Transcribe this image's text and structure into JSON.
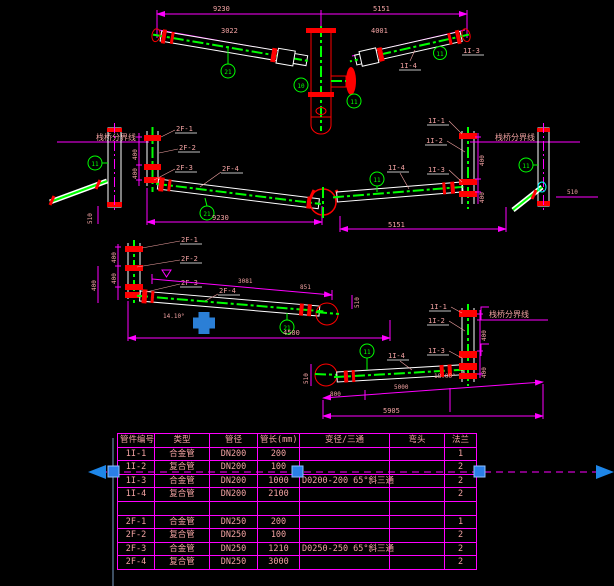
{
  "drawing": {
    "background": "#000000",
    "colors": {
      "dimension_line": "#ff00ff",
      "pipe_outline": "#ffffff",
      "pipe_centerline": "#00ff00",
      "fitting_red": "#ff0000",
      "label_text": "#f2a2a2",
      "grip_blue": "#2a7fe8"
    },
    "top_view": {
      "dim_left": "9230",
      "dim_right": "5151",
      "dim_arm_left": "3022",
      "dim_arm_right": "4001",
      "label_arm_right": "1I-4",
      "label_tip_right": "1I-3",
      "callout_left": "21",
      "callout_center": "10",
      "callout_nozzle": "11",
      "callout_right": "11"
    },
    "left_elevation": {
      "boundary_text": "栈桥分界线",
      "labels": [
        "2F-1",
        "2F-2",
        "2F-3",
        "2F-4"
      ],
      "callout_post": "11",
      "callout_arm": "21",
      "dim_bottom": "9230",
      "dim_chain": [
        "400",
        "400"
      ],
      "dim_post": "510"
    },
    "right_elevation": {
      "boundary_text": "栈桥分界线",
      "labels": [
        "1I-1",
        "1I-2",
        "1I-3",
        "1I-4"
      ],
      "callout_post": "11",
      "callout_arm": "11",
      "dim_bottom": "5151",
      "dim_chain": [
        "400",
        "400"
      ],
      "dim_post": "510"
    },
    "left_detail": {
      "labels": [
        "2F-1",
        "2F-2",
        "2F-3",
        "2F-4"
      ],
      "callout": "21",
      "dim_bottom": "4500",
      "dim_slope": "3081",
      "dim_slope_end": "851",
      "dim_end": "510",
      "angle": "14.10°",
      "dim_chain": [
        "400",
        "400",
        "400"
      ]
    },
    "right_detail": {
      "boundary_text": "栈桥分界线",
      "labels": [
        "1I-1",
        "1I-2",
        "1I-3",
        "1I-4"
      ],
      "callout": "11",
      "dim_left": "800",
      "dim_mid": "5000",
      "dim_bottom": "5905",
      "dim_end": "510",
      "angle": "18.00°",
      "dim_chain": [
        "400",
        "400"
      ]
    }
  },
  "table": {
    "headers": [
      "管件编号",
      "类型",
      "管径",
      "管长(mm)",
      "变径/三通",
      "弯头",
      "法兰"
    ],
    "rows": [
      [
        "1I-1",
        "合金管",
        "DN200",
        "200",
        "",
        "",
        "1"
      ],
      [
        "1I-2",
        "复合管",
        "DN200",
        "100",
        "",
        "",
        "2"
      ],
      [
        "1I-3",
        "合金管",
        "DN200",
        "1000",
        "D0200-200  65°斜三通",
        "",
        "2"
      ],
      [
        "1I-4",
        "复合管",
        "DN200",
        "2100",
        "",
        "",
        "2"
      ],
      [
        "",
        "",
        "",
        "",
        "",
        "",
        ""
      ],
      [
        "2F-1",
        "合金管",
        "DN250",
        "200",
        "",
        "",
        "1"
      ],
      [
        "2F-2",
        "复合管",
        "DN250",
        "100",
        "",
        "",
        "2"
      ],
      [
        "2F-3",
        "合金管",
        "DN250",
        "1210",
        "D0250-250  65°斜三通",
        "",
        "2"
      ],
      [
        "2F-4",
        "复合管",
        "DN250",
        "3000",
        "",
        "",
        "2"
      ]
    ]
  }
}
